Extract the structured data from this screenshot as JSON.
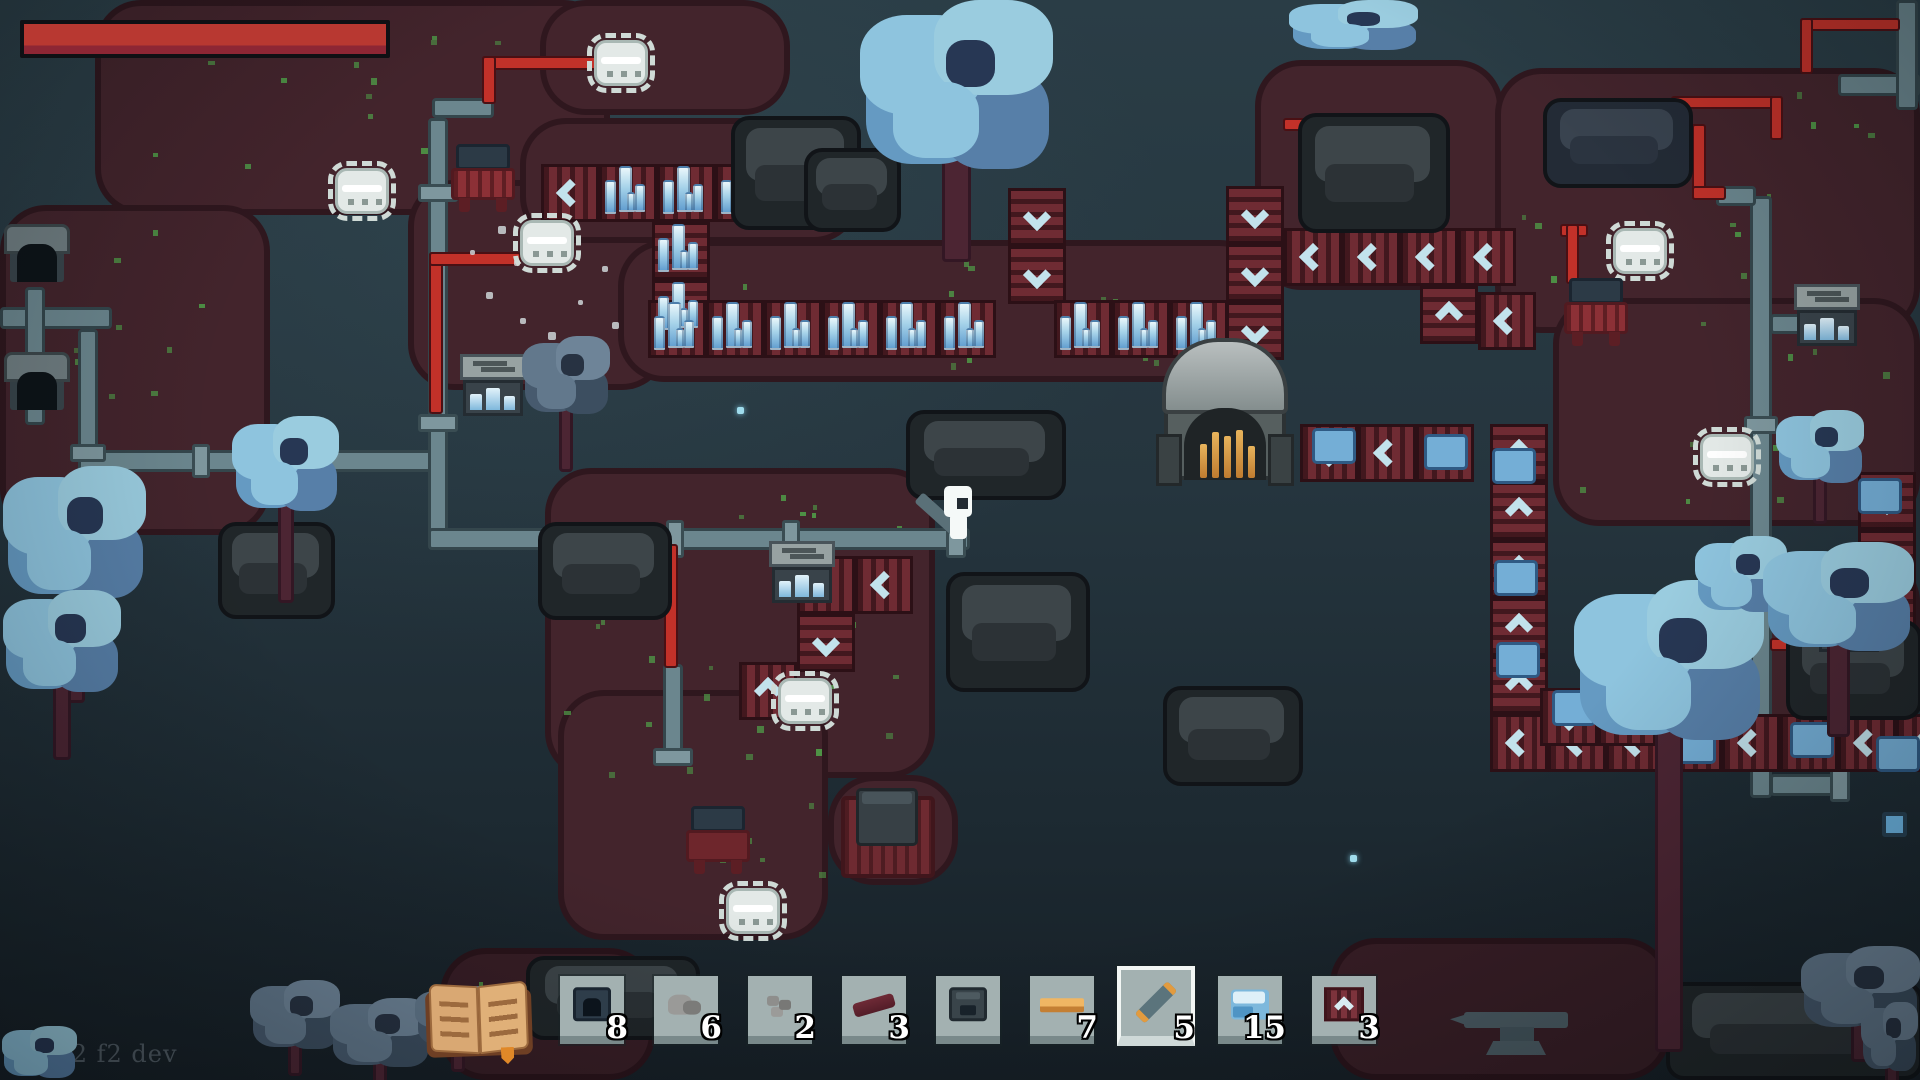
{
  "hud": {
    "version_label": "v0.22 f2 dev",
    "health_bar": {
      "value_ratio": 1.0,
      "fill_color": "#b83831"
    }
  },
  "hotbar": {
    "slots": [
      {
        "icon": "miner-machine",
        "count": "8",
        "selected": false
      },
      {
        "icon": "stone-pile",
        "count": "6",
        "selected": false
      },
      {
        "icon": "stone-chunks",
        "count": "2",
        "selected": false
      },
      {
        "icon": "red-beam",
        "count": "3",
        "selected": false
      },
      {
        "icon": "furnace",
        "count": "",
        "selected": false
      },
      {
        "icon": "metal-bar",
        "count": "7",
        "selected": false
      },
      {
        "icon": "pipe-item",
        "count": "5",
        "selected": true
      },
      {
        "icon": "ice-crystal",
        "count": "15",
        "selected": false
      },
      {
        "icon": "conveyor-belt",
        "count": "3",
        "selected": false
      }
    ],
    "slot_left_positions": [
      560,
      654,
      748,
      842,
      936,
      1030,
      1124,
      1218,
      1312
    ],
    "slot_top": 976
  },
  "palette": {
    "health_red": "#b83831",
    "ground_red": "#43242c",
    "background_teal": "#24343d",
    "belt_red": "#6f2b33",
    "chevron_blue": "#c2e2ec",
    "pipe_gray": "#6b868e",
    "wire_red": "#c23129",
    "crystal_blue": "#a8d4ea",
    "selected_slot_border": "#f2f6f4",
    "count_text": "#ffffff"
  },
  "world": {
    "ground_patches": [
      [
        95,
        0,
        515,
        215,
        0
      ],
      [
        540,
        0,
        250,
        115,
        0
      ],
      [
        0,
        205,
        270,
        330,
        0
      ],
      [
        408,
        180,
        260,
        210,
        0
      ],
      [
        520,
        118,
        340,
        125,
        0
      ],
      [
        618,
        240,
        648,
        142,
        0
      ],
      [
        545,
        468,
        390,
        310,
        0
      ],
      [
        558,
        690,
        270,
        250,
        0
      ],
      [
        1255,
        60,
        248,
        230,
        0
      ],
      [
        1495,
        68,
        425,
        265,
        0
      ],
      [
        1553,
        298,
        367,
        228,
        0
      ],
      [
        1700,
        556,
        220,
        168,
        0
      ],
      [
        1330,
        938,
        340,
        142,
        1
      ],
      [
        440,
        948,
        215,
        132,
        1
      ],
      [
        828,
        775,
        130,
        110,
        0
      ]
    ],
    "speck_areas": [
      [
        120,
        30,
        420,
        160,
        14
      ],
      [
        30,
        230,
        200,
        260,
        10
      ],
      [
        640,
        260,
        560,
        110,
        16
      ],
      [
        560,
        490,
        340,
        260,
        22
      ],
      [
        600,
        700,
        220,
        200,
        12
      ],
      [
        1510,
        90,
        380,
        220,
        20
      ],
      [
        1570,
        320,
        330,
        180,
        12
      ],
      [
        450,
        960,
        180,
        100,
        6
      ],
      [
        860,
        120,
        80,
        60,
        4
      ]
    ],
    "pipes": [
      [
        0,
        307,
        112,
        22
      ],
      [
        25,
        287,
        20,
        138
      ],
      [
        78,
        329,
        20,
        125
      ],
      [
        78,
        450,
        356,
        22
      ],
      [
        428,
        118,
        20,
        432
      ],
      [
        432,
        98,
        62,
        20
      ],
      [
        428,
        528,
        542,
        22
      ],
      [
        663,
        664,
        20,
        94
      ],
      [
        1750,
        196,
        22,
        602
      ],
      [
        1716,
        186,
        40,
        20
      ],
      [
        1770,
        314,
        36,
        20
      ],
      [
        1770,
        774,
        74,
        22
      ],
      [
        1838,
        74,
        82,
        22
      ],
      [
        1896,
        0,
        22,
        110
      ]
    ],
    "flanges": [
      [
        418,
        184,
        40,
        18
      ],
      [
        418,
        414,
        40,
        18
      ],
      [
        666,
        520,
        18,
        38
      ],
      [
        782,
        520,
        18,
        38
      ],
      [
        946,
        514,
        20,
        44
      ],
      [
        192,
        444,
        18,
        34
      ],
      [
        1744,
        416,
        34,
        18
      ],
      [
        1744,
        558,
        34,
        18
      ],
      [
        1830,
        766,
        20,
        36
      ],
      [
        653,
        748,
        40,
        18
      ],
      [
        70,
        444,
        36,
        18
      ]
    ],
    "wires": [
      [
        482,
        56,
        120,
        14
      ],
      [
        482,
        56,
        14,
        48
      ],
      [
        429,
        252,
        14,
        162
      ],
      [
        429,
        252,
        92,
        14
      ],
      [
        664,
        544,
        14,
        124
      ],
      [
        1560,
        124,
        144,
        14
      ],
      [
        1692,
        124,
        14,
        76
      ],
      [
        1692,
        186,
        34,
        14
      ],
      [
        1560,
        224,
        28,
        13
      ],
      [
        1566,
        224,
        13,
        60
      ],
      [
        1283,
        118,
        44,
        13
      ],
      [
        1770,
        638,
        54,
        13
      ],
      [
        1671,
        96,
        112,
        13
      ],
      [
        1770,
        96,
        13,
        44
      ],
      [
        1800,
        18,
        100,
        13
      ],
      [
        1800,
        18,
        13,
        56
      ]
    ],
    "belt_runs": [
      [
        1008,
        188,
        "v",
        2,
        "d"
      ],
      [
        1226,
        186,
        "v",
        3,
        "d"
      ],
      [
        1284,
        228,
        "h",
        4,
        "l"
      ],
      [
        1420,
        286,
        "v",
        1,
        "u"
      ],
      [
        1478,
        292,
        "h",
        1,
        "l"
      ],
      [
        1300,
        424,
        "h",
        3,
        "l"
      ],
      [
        1490,
        424,
        "v",
        5,
        "u"
      ],
      [
        1490,
        714,
        "h",
        8,
        "l"
      ],
      [
        1858,
        472,
        "v",
        4,
        "d"
      ],
      [
        1540,
        688,
        "h",
        2,
        "l"
      ],
      [
        797,
        556,
        "h",
        2,
        "l"
      ],
      [
        797,
        614,
        "v",
        1,
        "d"
      ],
      [
        739,
        662,
        "h",
        1,
        "u"
      ],
      [
        541,
        164,
        "h",
        1,
        "l"
      ]
    ],
    "spike_runs": [
      [
        599,
        164,
        "h",
        4
      ],
      [
        652,
        222,
        "v",
        2
      ],
      [
        648,
        300,
        "h",
        6
      ],
      [
        1054,
        300,
        "h",
        3
      ]
    ],
    "ice_items": [
      [
        1312,
        428
      ],
      [
        1424,
        434
      ],
      [
        1492,
        448
      ],
      [
        1494,
        560
      ],
      [
        1496,
        642
      ],
      [
        1552,
        690
      ],
      [
        1598,
        688
      ],
      [
        1606,
        696
      ],
      [
        1672,
        728
      ],
      [
        1790,
        722
      ],
      [
        1858,
        478
      ],
      [
        1862,
        556
      ],
      [
        1860,
        630
      ],
      [
        1876,
        736
      ]
    ],
    "trees": [
      [
        856,
        0,
        205,
        182,
        80,
        "b"
      ],
      [
        1286,
        0,
        138,
        54,
        0,
        "b"
      ],
      [
        0,
        466,
        152,
        142,
        95,
        "b"
      ],
      [
        0,
        590,
        126,
        110,
        60,
        "b"
      ],
      [
        230,
        416,
        114,
        102,
        85,
        "b"
      ],
      [
        520,
        336,
        94,
        84,
        52,
        "g"
      ],
      [
        1570,
        580,
        202,
        172,
        300,
        "b"
      ],
      [
        1693,
        536,
        98,
        82,
        0,
        "b"
      ],
      [
        1760,
        542,
        160,
        117,
        78,
        "b"
      ],
      [
        1774,
        410,
        94,
        78,
        36,
        "b"
      ],
      [
        248,
        980,
        96,
        74,
        22,
        "g"
      ],
      [
        328,
        998,
        106,
        74,
        20,
        "g"
      ],
      [
        413,
        986,
        90,
        66,
        20,
        "g"
      ],
      [
        1798,
        946,
        127,
        90,
        26,
        "g"
      ],
      [
        1860,
        1002,
        60,
        74,
        16,
        "g"
      ],
      [
        0,
        1026,
        80,
        56,
        0,
        "b"
      ]
    ],
    "rocks": [
      [
        731,
        116,
        130,
        114,
        0
      ],
      [
        804,
        148,
        97,
        84,
        0
      ],
      [
        1298,
        113,
        152,
        120,
        0
      ],
      [
        1543,
        98,
        150,
        90,
        1
      ],
      [
        218,
        522,
        117,
        97,
        0
      ],
      [
        906,
        410,
        160,
        90,
        0
      ],
      [
        538,
        522,
        134,
        98,
        0
      ],
      [
        946,
        572,
        144,
        120,
        0
      ],
      [
        1163,
        686,
        140,
        100,
        0
      ],
      [
        1786,
        620,
        136,
        100,
        0
      ],
      [
        1666,
        982,
        257,
        98,
        0
      ],
      [
        526,
        956,
        174,
        84,
        0
      ]
    ],
    "crystals": [
      [
        22,
        180,
        1.0
      ],
      [
        30,
        146,
        0.7
      ],
      [
        226,
        292,
        0.9
      ],
      [
        1041,
        0,
        0.7
      ],
      [
        1312,
        0,
        0.9
      ],
      [
        1849,
        120,
        1.1
      ],
      [
        1813,
        226,
        1.0
      ],
      [
        1283,
        266,
        0.7
      ],
      [
        1583,
        386,
        1.0
      ],
      [
        788,
        610,
        1.1
      ],
      [
        852,
        460,
        0.8
      ],
      [
        741,
        816,
        0.9
      ],
      [
        1366,
        996,
        1.0
      ],
      [
        1383,
        1031,
        0.8
      ],
      [
        1618,
        1026,
        0.9
      ],
      [
        1485,
        198,
        0.6
      ],
      [
        534,
        266,
        1.2
      ]
    ],
    "dots": [
      [
        505,
        383
      ],
      [
        1350,
        855
      ],
      [
        737,
        407
      ]
    ],
    "pickups": [
      [
        1882,
        812
      ]
    ],
    "particles": [
      [
        498,
        226,
        8
      ],
      [
        514,
        260,
        6
      ],
      [
        486,
        292,
        7
      ],
      [
        520,
        318,
        6
      ],
      [
        548,
        332,
        8
      ],
      [
        578,
        300,
        5
      ],
      [
        602,
        266,
        6
      ],
      [
        562,
        236,
        5
      ],
      [
        612,
        322,
        7
      ],
      [
        538,
        352,
        6
      ],
      [
        470,
        250,
        5
      ],
      [
        590,
        352,
        5
      ]
    ],
    "drills": [
      [
        594,
        40
      ],
      [
        520,
        220
      ],
      [
        335,
        168
      ],
      [
        778,
        678
      ],
      [
        726,
        888
      ],
      [
        1613,
        228
      ],
      [
        1700,
        434
      ]
    ],
    "miners": [
      [
        451,
        144
      ],
      [
        1564,
        278
      ]
    ],
    "dark_miners": [
      [
        686,
        806
      ]
    ],
    "tunnels": [
      [
        4,
        224
      ],
      [
        4,
        352
      ]
    ],
    "storage_boxes": [
      [
        460,
        354
      ],
      [
        769,
        541
      ],
      [
        1794,
        284
      ],
      [
        1816,
        590
      ]
    ],
    "big_furnace": [
      1156,
      338
    ],
    "furnace_platform": [
      841,
      796
    ],
    "anvil": [
      1450,
      1008
    ],
    "character": [
      910,
      484
    ]
  }
}
